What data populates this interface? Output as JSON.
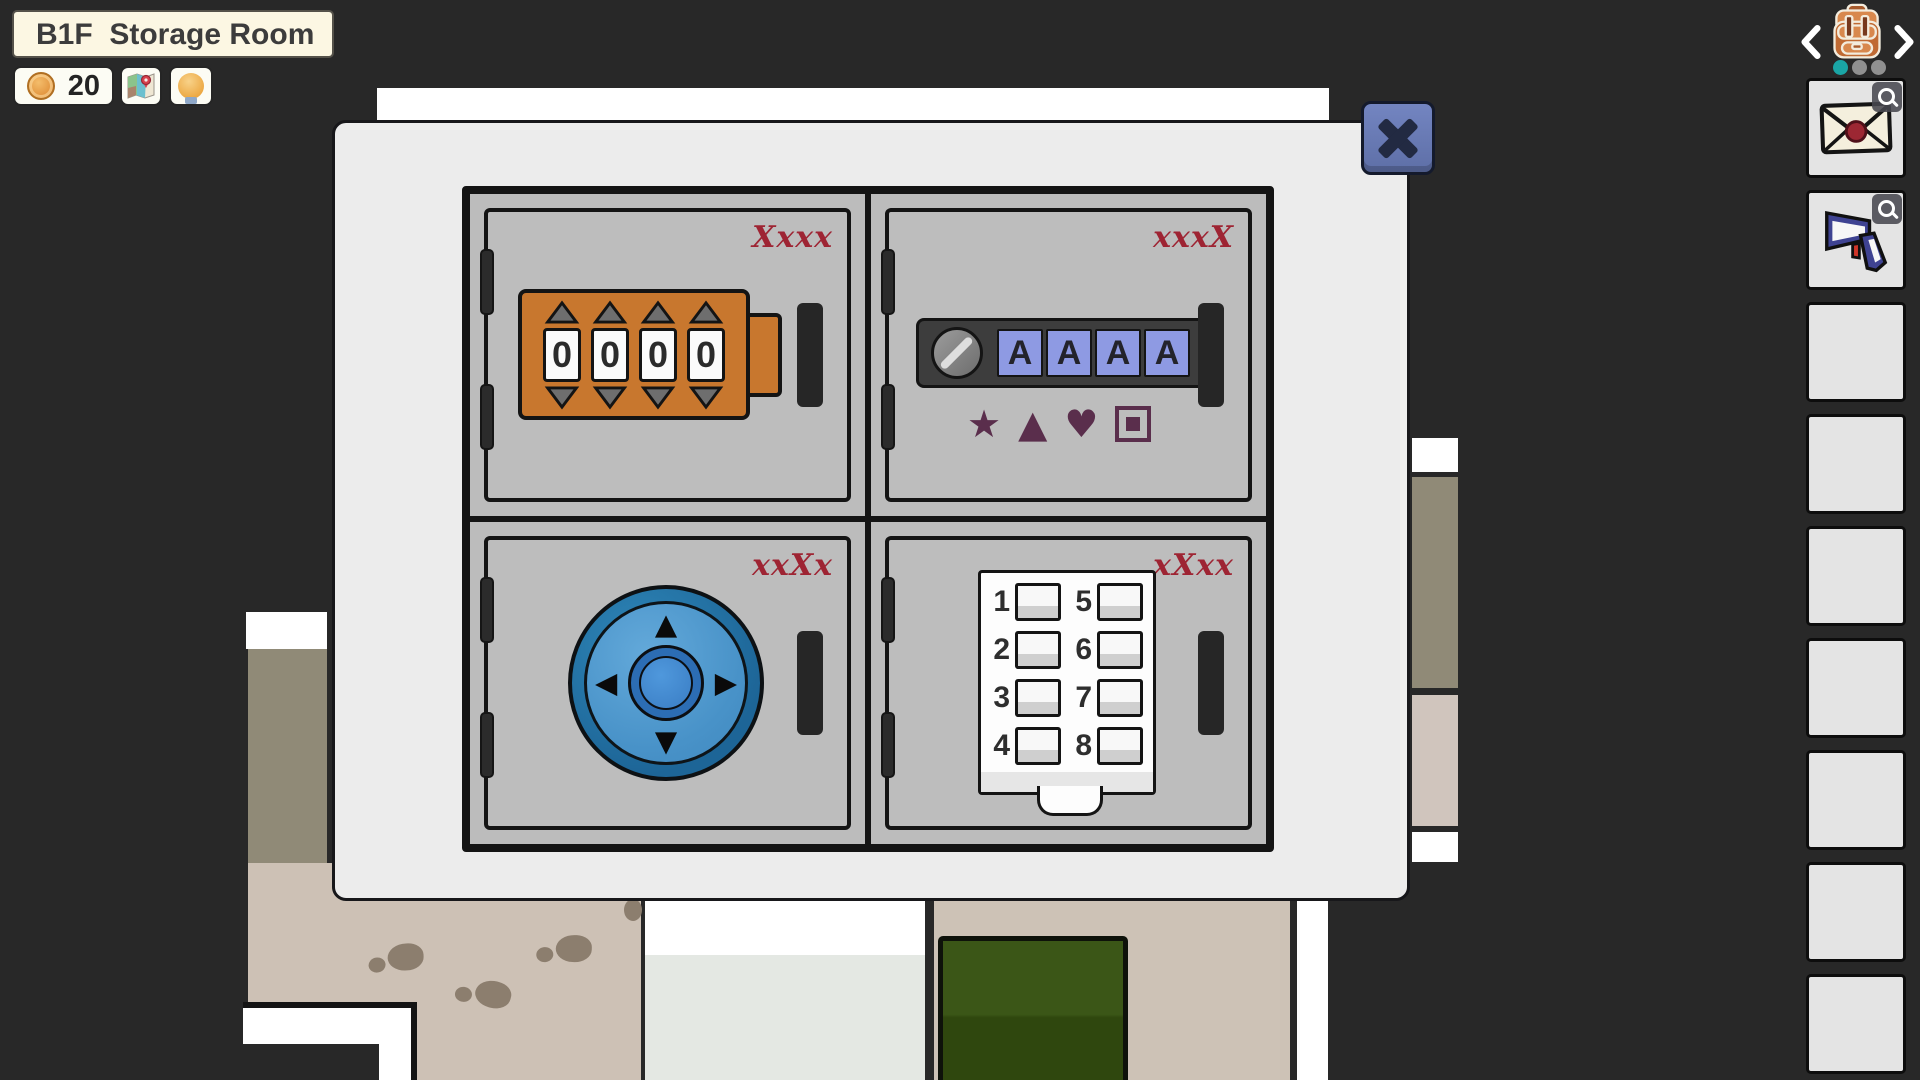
{
  "hud": {
    "location": "B1F  Storage Room",
    "coins": "20"
  },
  "inventory": {
    "items": [
      {
        "icon": "sealed-envelope"
      },
      {
        "icon": "barcode-scanner"
      }
    ],
    "empty_slot_count": 7,
    "pager": {
      "dots": 3,
      "active": 1
    }
  },
  "modal": {
    "close_glyph": "✕",
    "lockers": [
      {
        "code_label": "Xxxx",
        "lock": "four-digit-dial",
        "digits": [
          "0",
          "0",
          "0",
          "0"
        ]
      },
      {
        "code_label": "xxxX",
        "lock": "four-letter-buttons",
        "letters": [
          "A",
          "A",
          "A",
          "A"
        ],
        "symbols": [
          "★",
          "▲",
          "♥"
        ],
        "fourth_symbol": "square-in-square"
      },
      {
        "code_label": "xxXx",
        "lock": "direction-pad",
        "arrows": {
          "up": "▲",
          "down": "▼",
          "left": "◀",
          "right": "▶"
        }
      },
      {
        "code_label": "xXxx",
        "lock": "number-keypad",
        "left_numbers": [
          "1",
          "2",
          "3",
          "4"
        ],
        "right_numbers": [
          "5",
          "6",
          "7",
          "8"
        ]
      }
    ]
  }
}
